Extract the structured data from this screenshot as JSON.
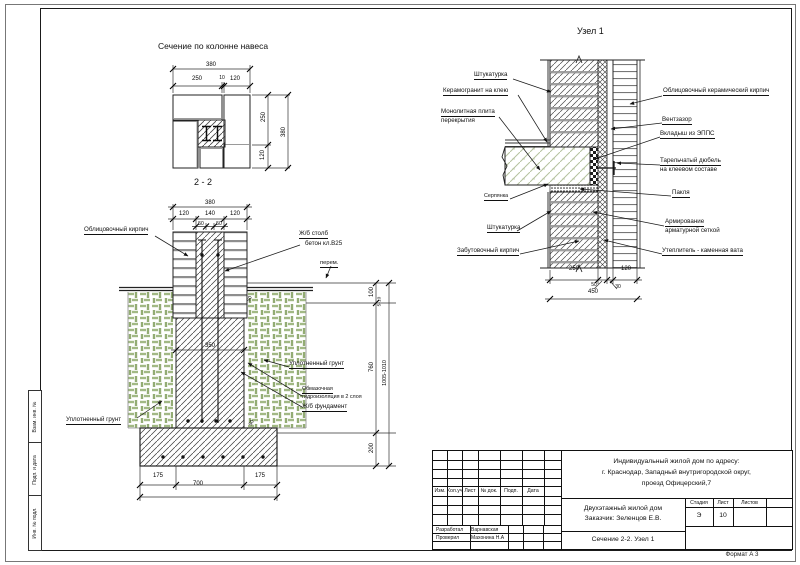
{
  "sheet": {
    "format": "Формат А 3"
  },
  "side_column": {
    "box1": "Взам. инв. №",
    "box2": "Подп. и дата",
    "box3": "Инв. № подл."
  },
  "plan": {
    "title": "Сечение по колонне навеса",
    "section_mark": "2 - 2",
    "dims": {
      "total_top": "380",
      "left": "250",
      "gap": "10",
      "right": "120",
      "side_top": "250",
      "side_bottom": "120",
      "side_total": "380"
    }
  },
  "foundation": {
    "labels": {
      "facing_brick": "Облицовочный кирпич",
      "column_line1": "Ж/б столб",
      "column_line2": "бетон кл.В25",
      "variable": "перем.",
      "soil_left": "Уплотненный грунт",
      "soil_right": "Уплотненный грунт",
      "waterproof_line1": "Обмазочная",
      "waterproof_line2": "гидроизоляция в 2 слоя",
      "footing": "Ж/б фундамент"
    },
    "dims": {
      "total_top": "380",
      "d120l": "120",
      "d140": "140",
      "d120r": "120",
      "d50a": "50",
      "d50b": "50",
      "d350": "350",
      "d175l": "175",
      "d700": "700",
      "d175r": "175",
      "d100": "100",
      "d5_10": "5-10",
      "d760": "760",
      "d200": "200",
      "dtotal": "1005-1010",
      "d50c": "50",
      "d50d": "50"
    }
  },
  "node1": {
    "title": "Узел 1",
    "labels": {
      "plaster_top": "Штукатурка",
      "tile": "Керамогранит на клею",
      "slab1": "Монолитная плита",
      "slab2": "перекрытия",
      "serpyanka": "Серпянка",
      "plaster_bottom": "Штукатурка",
      "backing_brick": "Забутовочный кирпич",
      "facing_brick": "Облицовочный керамический кирпич",
      "air_gap": "Вентзазор",
      "epps": "Вкладыш из ЭППС",
      "dowel1": "Тарельчатый дюбель",
      "dowel2": "на клеевом составе",
      "oakum": "Пакля",
      "mesh1": "Армирование",
      "mesh2": "арматурной сеткой",
      "insulation": "Утеплитель - каменная вата"
    },
    "dims": {
      "d250": "250",
      "d50": "50",
      "d30": "30",
      "d120": "120",
      "d450": "450"
    }
  },
  "title_block": {
    "cols": {
      "izm": "Изм.",
      "kol": "Кол.уч",
      "list": "Лист",
      "doc": "№ док.",
      "podp": "Подп.",
      "data": "Дата"
    },
    "project_line1": "Индивидуальный жилой дом по адресу:",
    "project_line2": "г. Краснодар, Западный внутригородской округ,",
    "project_line3": "проезд Офицерский,7",
    "object_line1": "Двухэтажный жилой дом",
    "object_line2": "Заказчик: Зеленцов Е.В.",
    "stage_label": "Стадия",
    "sheet_label": "Лист",
    "sheets_label": "Листов",
    "stage_value": "Э",
    "sheet_value": "10",
    "developed_label": "Разработал",
    "developed_name": "Варнавская",
    "checked_label": "Проверил",
    "checked_name": "Махонина Н.А",
    "doc_title": "Сечение 2-2. Узел 1"
  }
}
